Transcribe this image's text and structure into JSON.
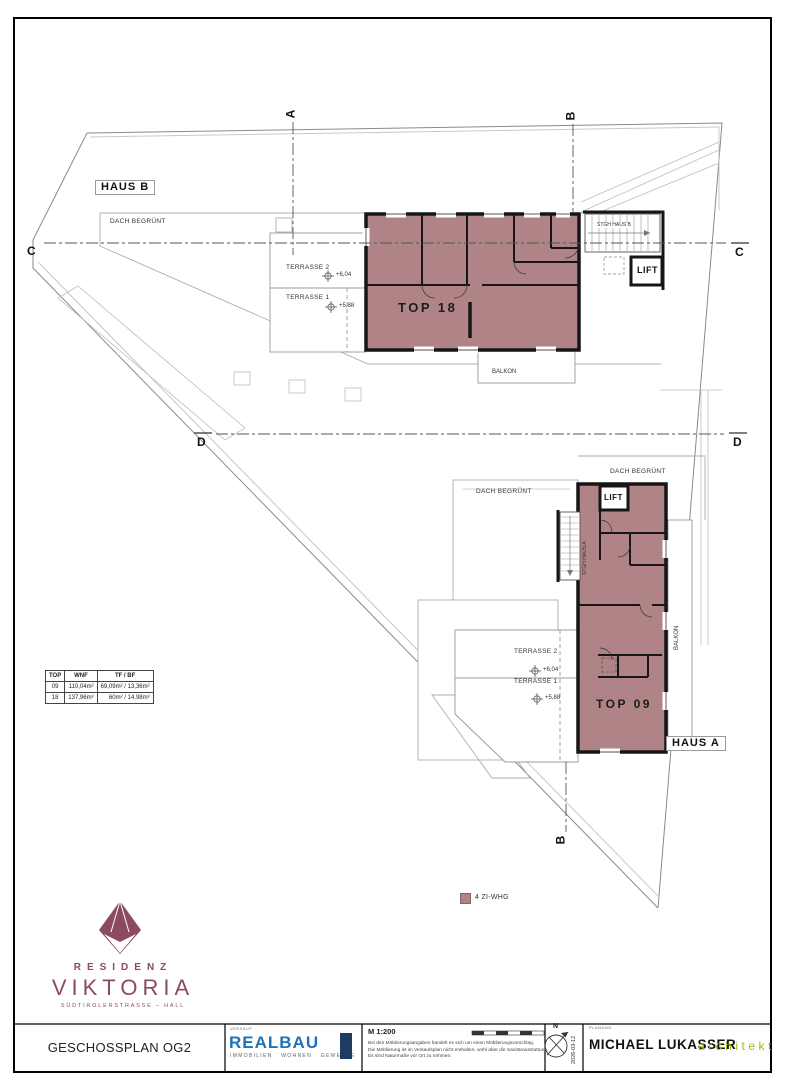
{
  "colors": {
    "unit_fill": "#b08486",
    "unit_stroke": "#161616",
    "logo_maroon": "#8c4a5e",
    "realbau_blue": "#1f72b8",
    "realbau_box": "#1d3b63",
    "architekt_green": "#a8b41c"
  },
  "plan": {
    "haus_b": "HAUS B",
    "haus_a": "HAUS A",
    "top18": "TOP 18",
    "top09": "TOP 09",
    "dach_begruent": "DACH BEGRÜNT",
    "terrasse2": "TERRASSE 2",
    "terrasse1": "TERRASSE 1",
    "level_604": "+6,04",
    "level_588": "+5,88",
    "stgh_haus_b": "STGH HAUS B",
    "stgh_haus_a": "STGH HAUS A",
    "lift": "LIFT",
    "balkon": "BALKON",
    "sections": {
      "a": "A",
      "b": "B",
      "c": "C",
      "d": "D"
    }
  },
  "table": {
    "headers": [
      "TOP",
      "WNF",
      "TF / BF"
    ],
    "rows": [
      [
        "09",
        "110,04m²",
        "69,09m² / 13,36m²"
      ],
      [
        "18",
        "137,96m²",
        "60m² / 14,98m²"
      ]
    ]
  },
  "legend": {
    "label": "4 ZI-WHG"
  },
  "logo": {
    "line1": "RESIDENZ",
    "line2": "VIKTORIA",
    "line3": "SÜDTIROLERSTRASSE – HALL"
  },
  "footer": {
    "plan_title": "GESCHOSSPLAN OG2",
    "verkauf": "VERKAUF",
    "realbau": "REALBAU",
    "realbau_tagline": "IMMOBILIEN WOHNEN GEWERBE",
    "scale": "M 1:200",
    "note1": "Bei den Möblierungsangaben handelt es sich um einen Möblierungsvorschlag.",
    "note2": "Die Möblierung ist im Verkaufsplan nicht enthalten, wohl aber die Sanitärausstattung.",
    "note3": "Es sind Naturmaße vor Ort zu nehmen.",
    "north": "N",
    "date": "2026-03-12",
    "planung": "PLANUNG",
    "architect": "MICHAEL LUKASSER",
    "architekt_label": "architekt"
  }
}
